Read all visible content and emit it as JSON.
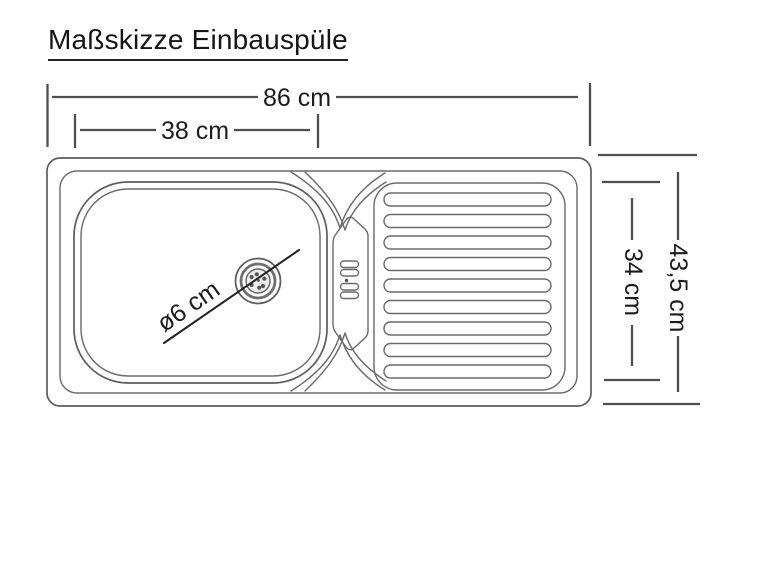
{
  "title": "Maßskizze Einbauspüle",
  "drawing": {
    "subject": "Einbauspüle",
    "view": "Draufsicht (top view)",
    "dimensions": {
      "total_width": {
        "label": "86 cm"
      },
      "basin_width": {
        "label": "38 cm"
      },
      "total_depth": {
        "label": "43,5 cm"
      },
      "inner_depth": {
        "label": "34 cm"
      },
      "drain_diameter": {
        "label": "ø6 cm"
      }
    },
    "colors": {
      "background": "#ffffff",
      "drawing_line": "#5c5c5c",
      "dimension_line": "#4f4f4f",
      "text": "#1c1c1c"
    }
  }
}
